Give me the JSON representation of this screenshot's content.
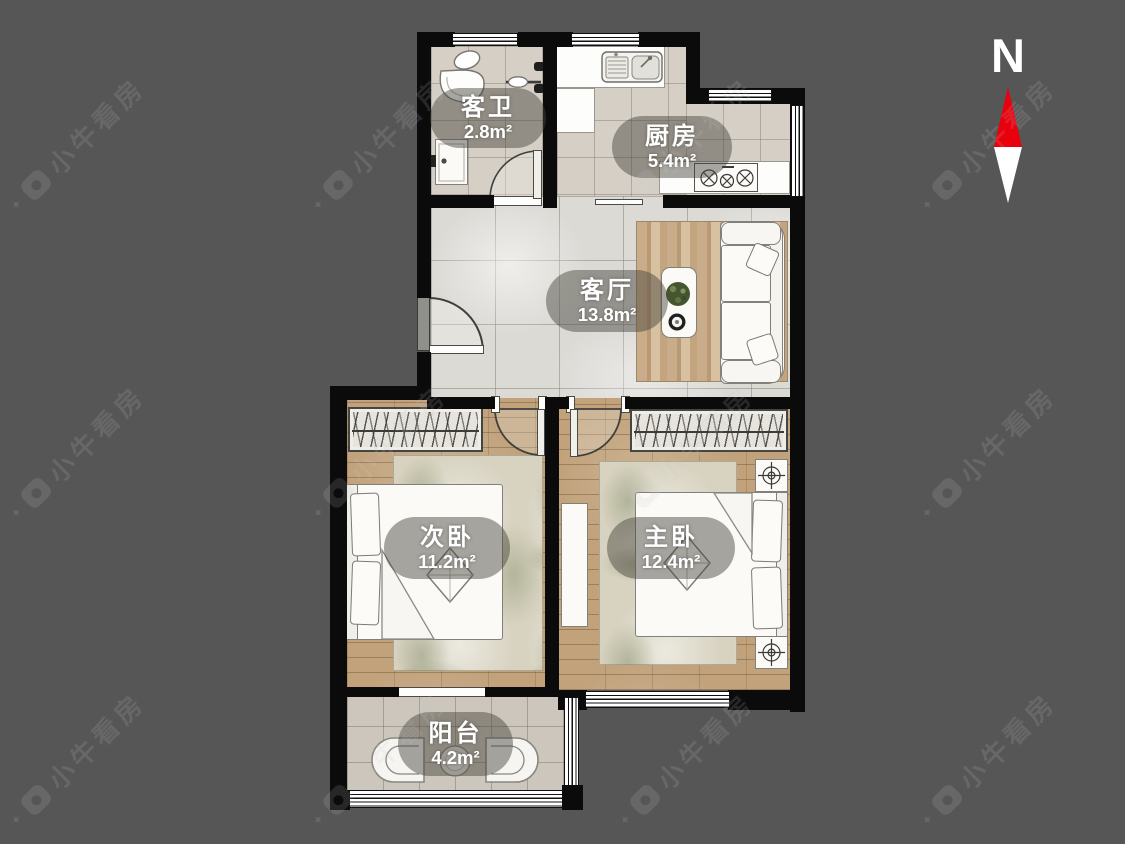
{
  "page": {
    "background": "#565656"
  },
  "compass": {
    "label": "N",
    "needle_up_color": "#e8000d",
    "needle_down_color": "#ffffff"
  },
  "watermark": {
    "text": "小牛看房"
  },
  "rooms": [
    {
      "id": "guest-bathroom",
      "name": "客卫",
      "area": "2.8m²"
    },
    {
      "id": "kitchen",
      "name": "厨房",
      "area": "5.4m²"
    },
    {
      "id": "living-room",
      "name": "客厅",
      "area": "13.8m²"
    },
    {
      "id": "secondary-bedroom",
      "name": "次卧",
      "area": "11.2m²"
    },
    {
      "id": "master-bedroom",
      "name": "主卧",
      "area": "12.4m²"
    },
    {
      "id": "balcony",
      "name": "阳台",
      "area": "4.2m²"
    }
  ],
  "colors": {
    "wall": "#0b0b0b",
    "label_pill": "rgba(70,67,60,0.47)",
    "wood_floor": "#c1a27b",
    "tile_floor": "#d5cfc6",
    "living_tile": "#dcdad5",
    "background": "#565656"
  }
}
